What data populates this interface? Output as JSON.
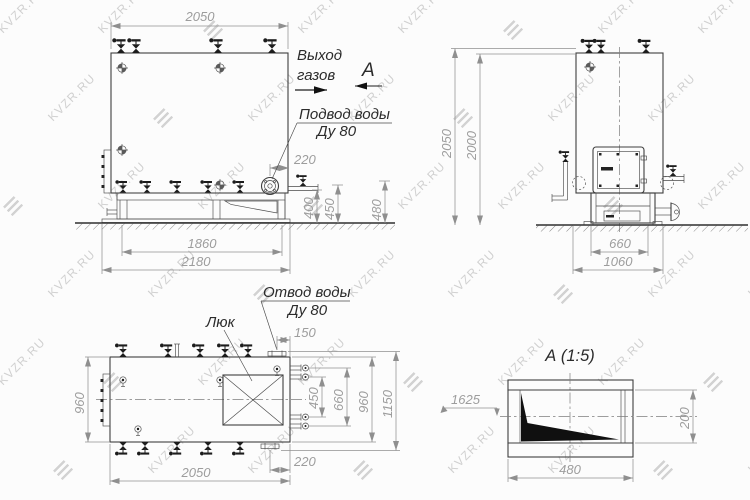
{
  "watermark": {
    "text": "KVZR.RU",
    "color": "#cccccc"
  },
  "drawing": {
    "labels": {
      "gas_outlet_1": "Выход",
      "gas_outlet_2": "газов",
      "section_mark": "А",
      "water_supply_1": "Подвод воды",
      "water_supply_2": "Ду 80",
      "water_drain_1": "Отвод воды",
      "water_drain_2": "Ду 80",
      "manhole": "Люк",
      "section_title": "А  (1:5)"
    },
    "front_view": {
      "length": "2050",
      "supply_offset": "220",
      "h_pipe": "400",
      "h_valve": "450",
      "h_flange": "480",
      "base_inner": "1860",
      "base_outer": "2180"
    },
    "side_view": {
      "height_overall": "2050",
      "height_body": "2000",
      "base_width": "660",
      "base_overall": "1060"
    },
    "plan_view": {
      "body_width": "960",
      "drain_offset": "150",
      "stub_span": "450",
      "stub_outer": "660",
      "overall_width": "1150",
      "length": "2050",
      "supply_offset": "220"
    },
    "section_view": {
      "elevation": "1625",
      "height": "200",
      "width": "480"
    }
  }
}
